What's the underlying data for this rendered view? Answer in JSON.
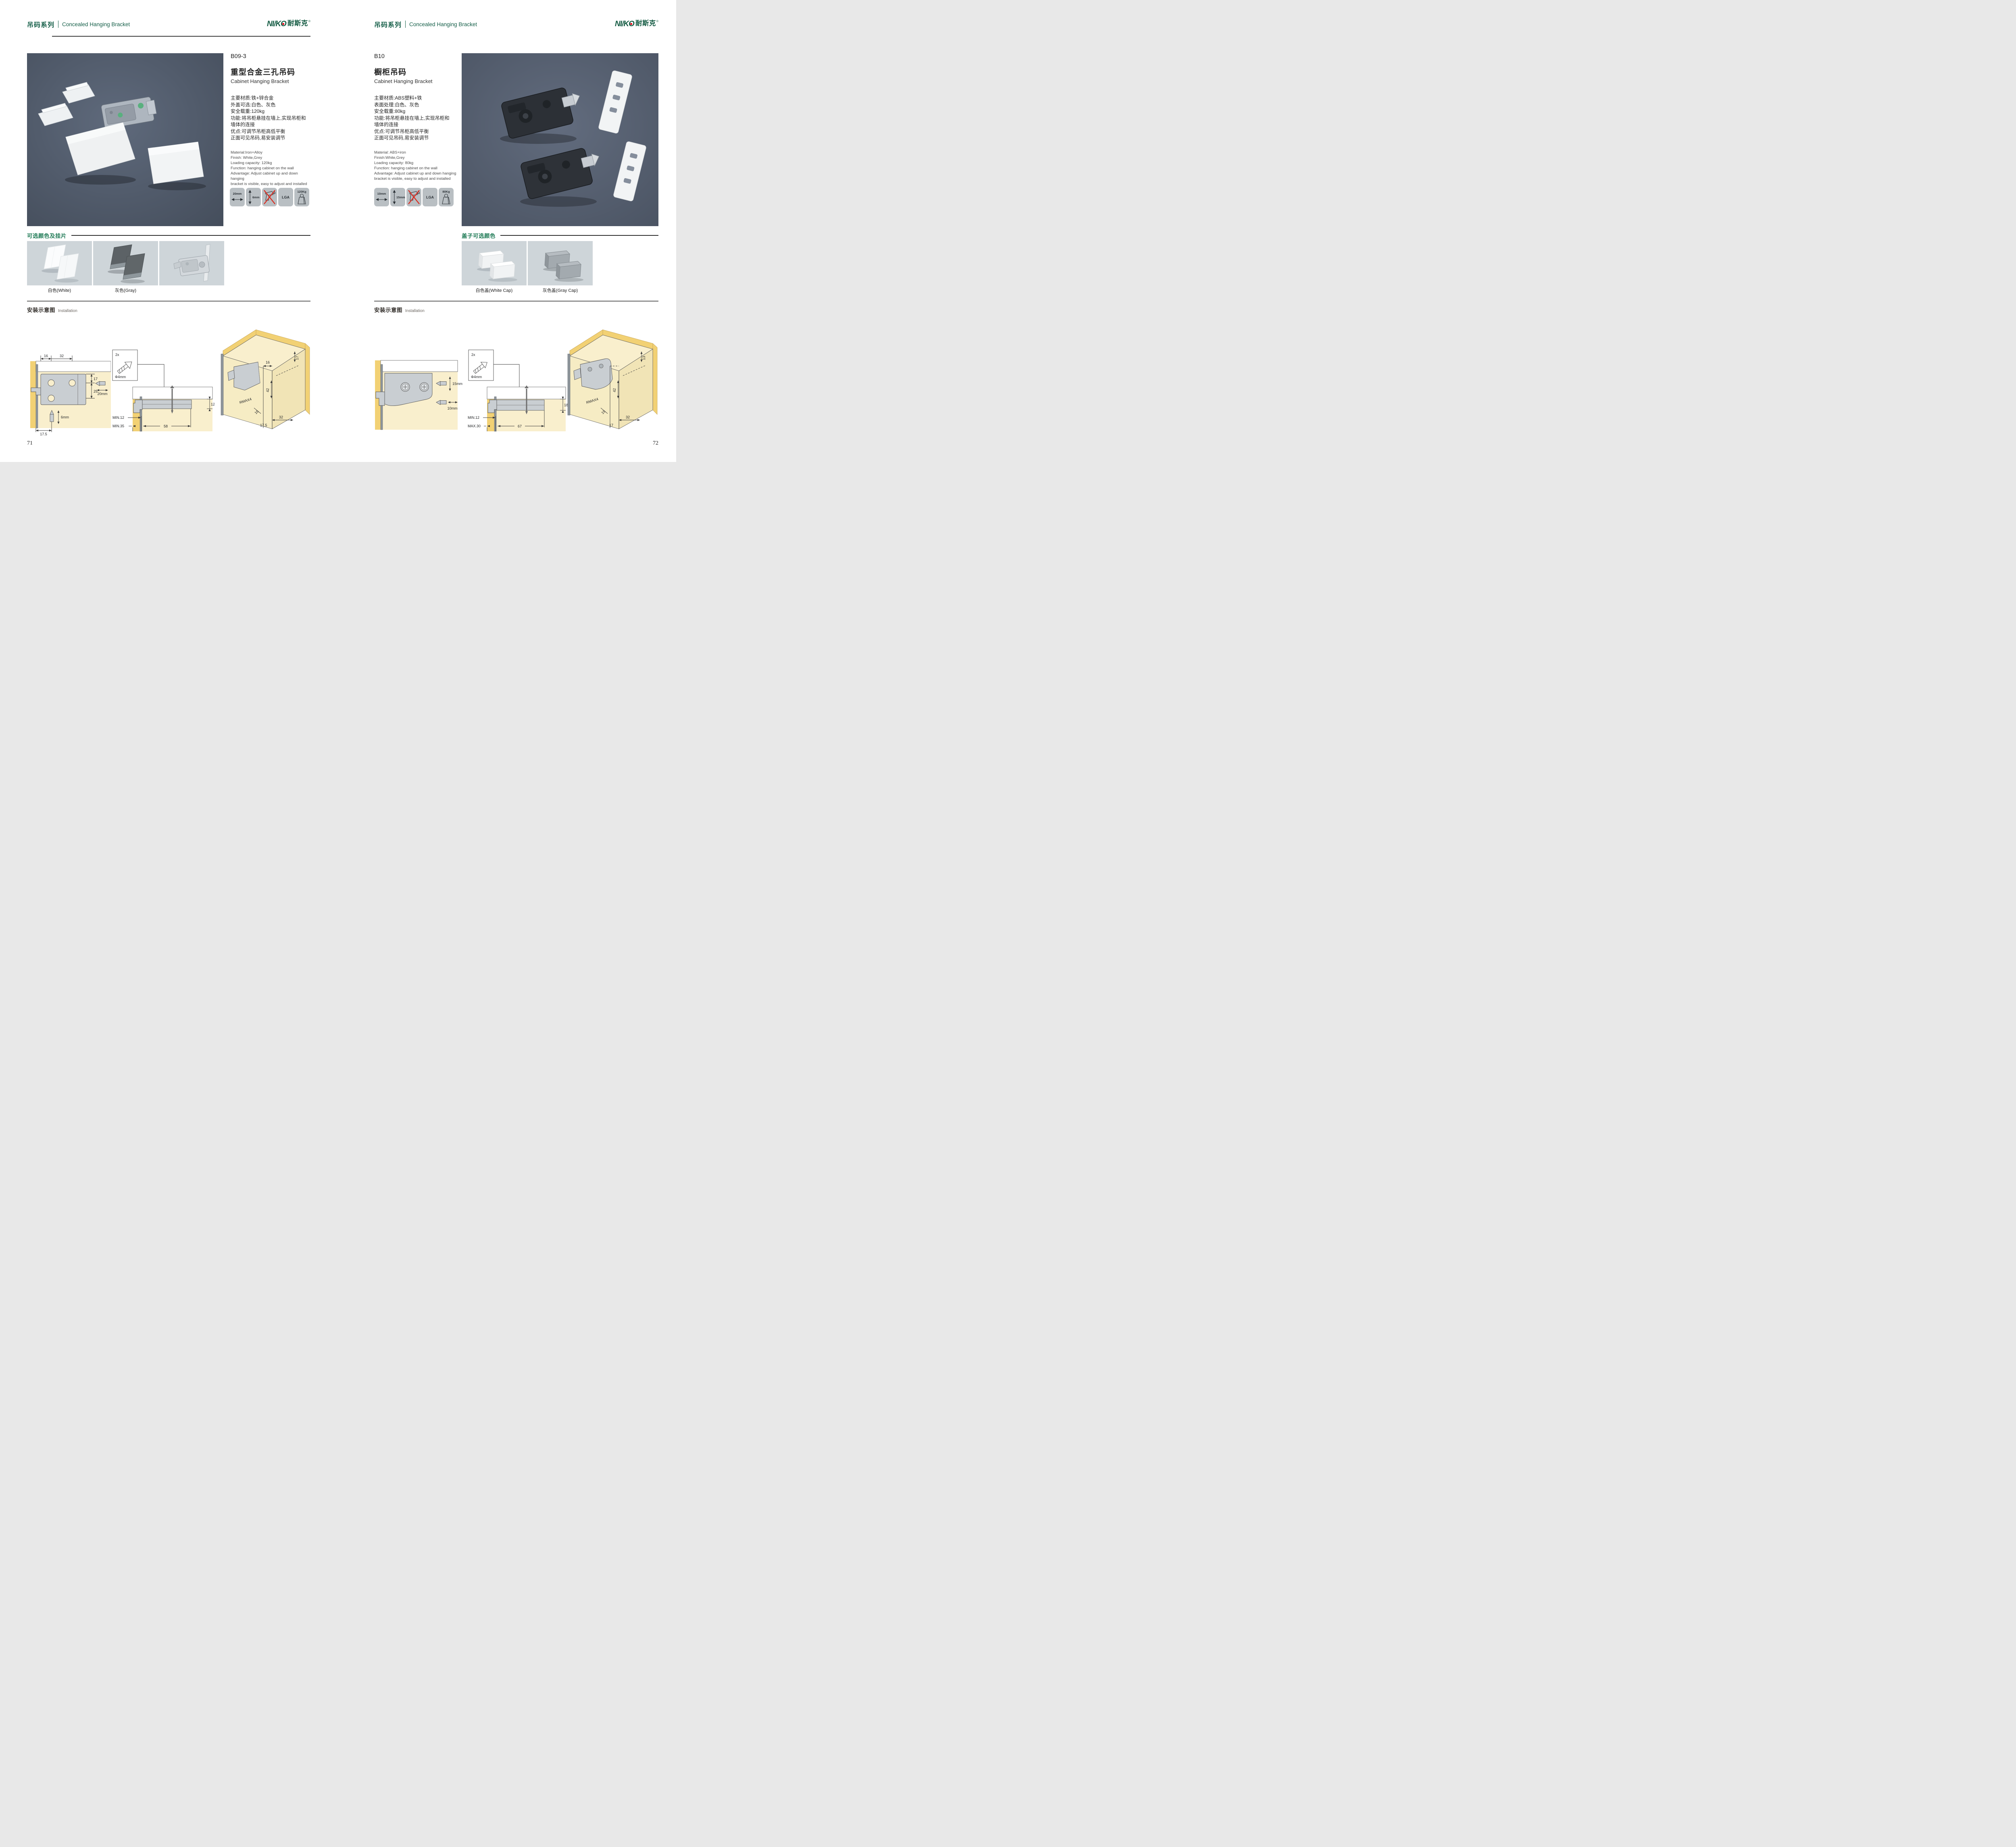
{
  "brand": {
    "logo_part1": "NI/K",
    "logo_part2": "O",
    "logo_cn": "耐斯克",
    "reg": "®"
  },
  "colors": {
    "accent_green": "#17604a",
    "section_green": "#1e7a55",
    "logo_red": "#e60012",
    "photo_bg": "#566173",
    "swatch_bg": "#ced5d9",
    "icon_bg": "#b9bfc3"
  },
  "pages": [
    {
      "header": {
        "series_cn": "吊码系列",
        "series_en": "Concealed Hanging Bracket"
      },
      "product": {
        "code": "B09-3",
        "title_cn": "重型合金三孔吊码",
        "title_en": "Cabinet Hanging Bracket"
      },
      "specs_cn": [
        "主要材质:铁+锌合金",
        "外盖可选:白色、灰色",
        "安全载重:120kg",
        "功能:将吊柜悬挂在墙上,实现吊柜和",
        "墙体的连接",
        "优点:可调节吊柜高低平衡",
        "正面可见吊码,易安装调节"
      ],
      "specs_en": [
        "Material:Iron+Alloy",
        "Finish: White,Grey",
        "Loading capacity: 120kg",
        "Function: hanging cabinet on the wall",
        "Advantage: Adjust cabinet up and down hanging",
        "bracket is visible, easy to adjust and installed"
      ],
      "icons": [
        {
          "label": "20mm"
        },
        {
          "label": "6mm"
        },
        {
          "label": ""
        },
        {
          "label": "LGA"
        },
        {
          "label": "120Kg"
        }
      ],
      "colors_section": {
        "title": "可选颜色及挂片",
        "labels": [
          "白色(White)",
          "灰色(Gray)"
        ]
      },
      "installation": {
        "title_cn": "安装示意图",
        "title_en": "Installation"
      },
      "diagrams": {
        "d1": {
          "top1": "16",
          "top2": "32",
          "r1": "17",
          "r2": "25",
          "bit_h": "20mm",
          "bit_v": "6mm",
          "bottom": "17.5"
        },
        "d2": {
          "count": "2x",
          "dia": "Φ4mm",
          "depth": "12",
          "l1": "MIN.12",
          "l2": "MIN.35",
          "span": "58"
        },
        "d3": {
          "a": "17",
          "b": "16",
          "c": "42",
          "d": "RMAX4",
          "e": "16",
          "f": "17.5",
          "g": "32"
        }
      },
      "page_number": "71"
    },
    {
      "header": {
        "series_cn": "吊码系列",
        "series_en": "Concealed Hanging Bracket"
      },
      "product": {
        "code": "B10",
        "title_cn": "橱柜吊码",
        "title_en": "Cabinet Hanging Bracket"
      },
      "specs_cn": [
        "主要材质:ABS塑料+铁",
        "表面处理:白色、灰色",
        "安全载重:80kg",
        "功能:将吊柜悬挂在墙上,实现吊柜和",
        "墙体的连接",
        "优点:可调节吊柜高低平衡",
        "正面可见吊码,易安装调节"
      ],
      "specs_en": [
        "Material: ABS+iron",
        "Finish:White,Grey",
        "Loading capacity: 80kg",
        "Function: hanging cabinet on the wall",
        "Advantage: Adjust cabinet up and down hanging",
        "bracket is visible, easy to adjust and installed"
      ],
      "icons": [
        {
          "label": "10mm"
        },
        {
          "label": "15mm"
        },
        {
          "label": ""
        },
        {
          "label": "LGA"
        },
        {
          "label": "80Kg"
        }
      ],
      "colors_section": {
        "title": "盖子可选颜色",
        "labels": [
          "白色盖(White Cap)",
          "灰色盖(Gray Cap)"
        ]
      },
      "installation": {
        "title_cn": "安装示意图",
        "title_en": "Installation"
      },
      "diagrams": {
        "d1": {
          "v": "15mm",
          "h": "10mm"
        },
        "d2": {
          "count": "2x",
          "dia": "Φ4mm",
          "depth": "18",
          "l1": "MIN.12",
          "l2": "MAX.30",
          "span": "67"
        },
        "d3": {
          "a": "13",
          "c": "42",
          "d": "RMAX4",
          "e": "19",
          "f": "17",
          "g": "32"
        }
      },
      "page_number": "72"
    }
  ]
}
